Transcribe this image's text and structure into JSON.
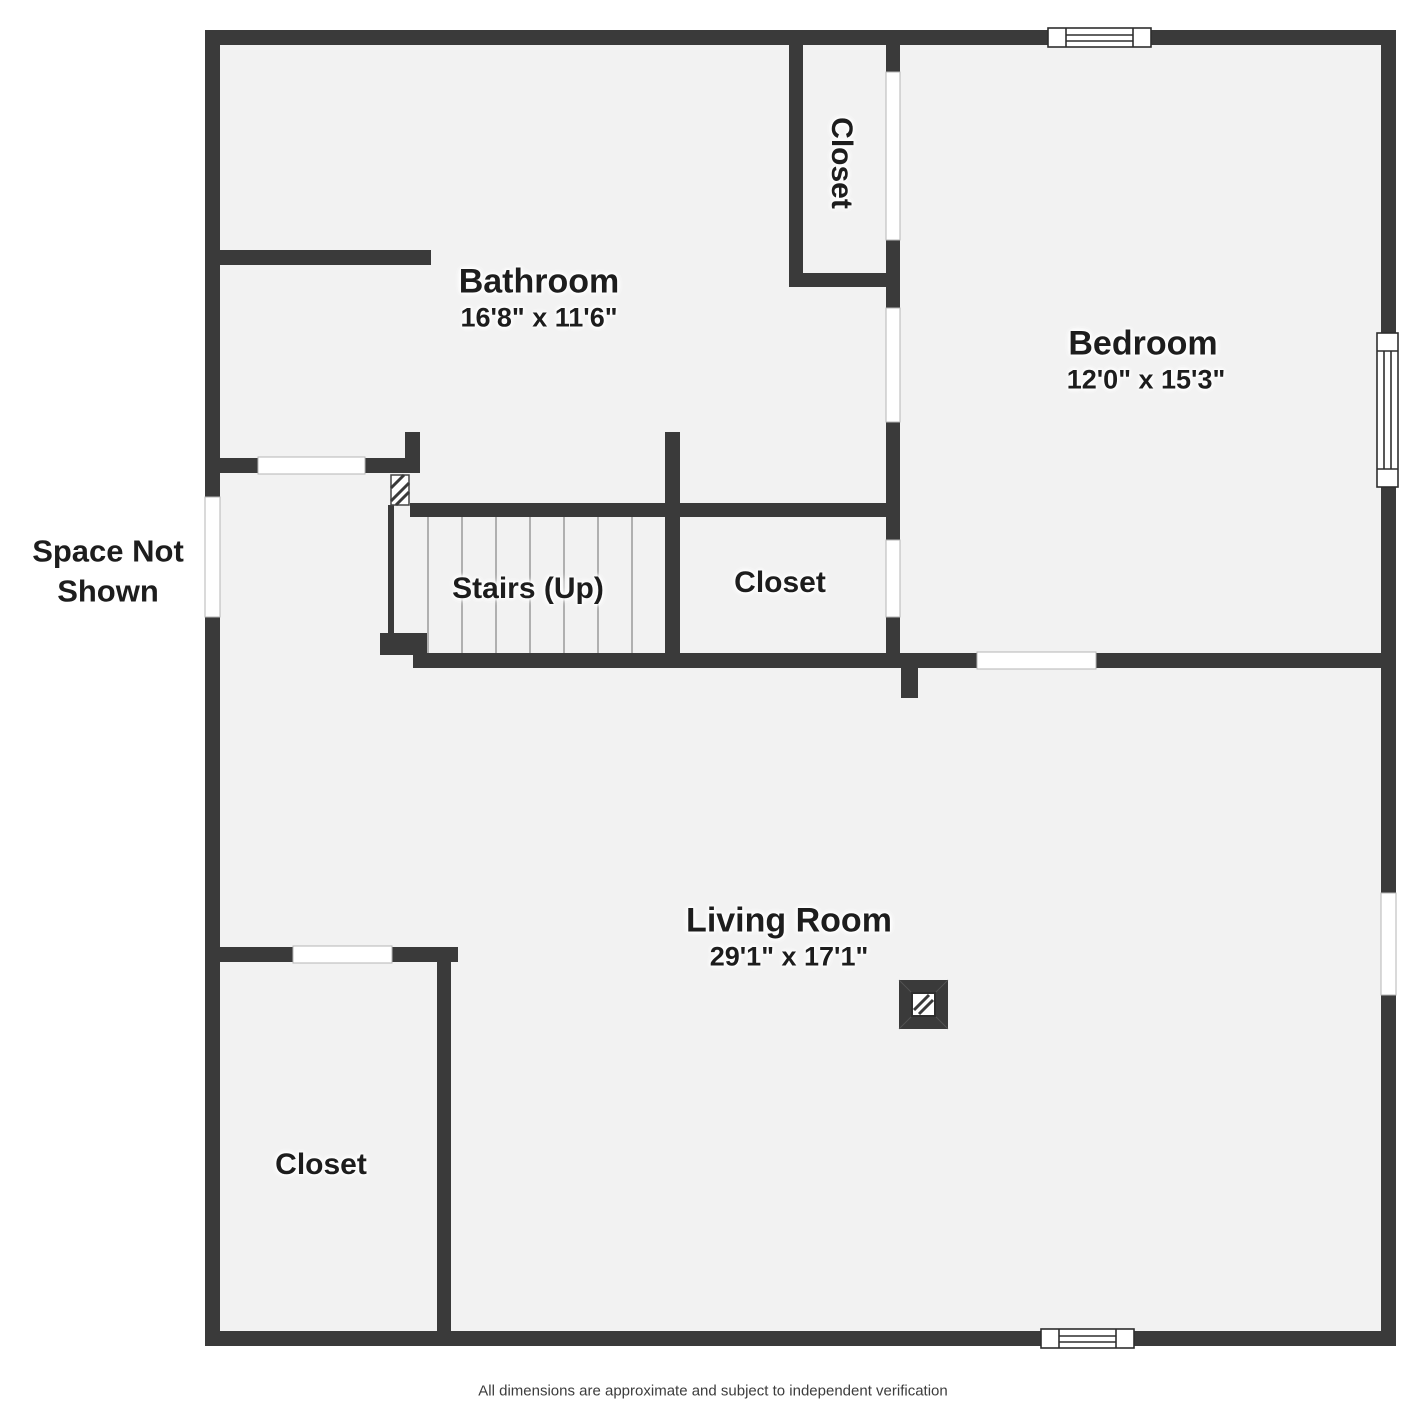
{
  "title": "Floor Plan",
  "rooms": {
    "bathroom": {
      "name": "Bathroom",
      "dims": "16'8\" x 11'6\""
    },
    "bedroom": {
      "name": "Bedroom",
      "dims": "12'0\" x 15'3\""
    },
    "closet_top": {
      "name": "Closet"
    },
    "stairs": {
      "name": "Stairs (Up)"
    },
    "closet_mid": {
      "name": "Closet"
    },
    "living_room": {
      "name": "Living Room",
      "dims": "29'1\" x 17'1\""
    },
    "closet_bottom": {
      "name": "Closet"
    },
    "space_not_shown": {
      "name": "Space Not Shown"
    }
  },
  "footer": {
    "disclaimer": "All dimensions are approximate and subject to independent verification"
  },
  "colors": {
    "wall": "#3a3a3a",
    "floor": "#f2f2f2",
    "background": "#ffffff",
    "label_text": "#1d1d1d",
    "window_fill": "#ffffff"
  }
}
